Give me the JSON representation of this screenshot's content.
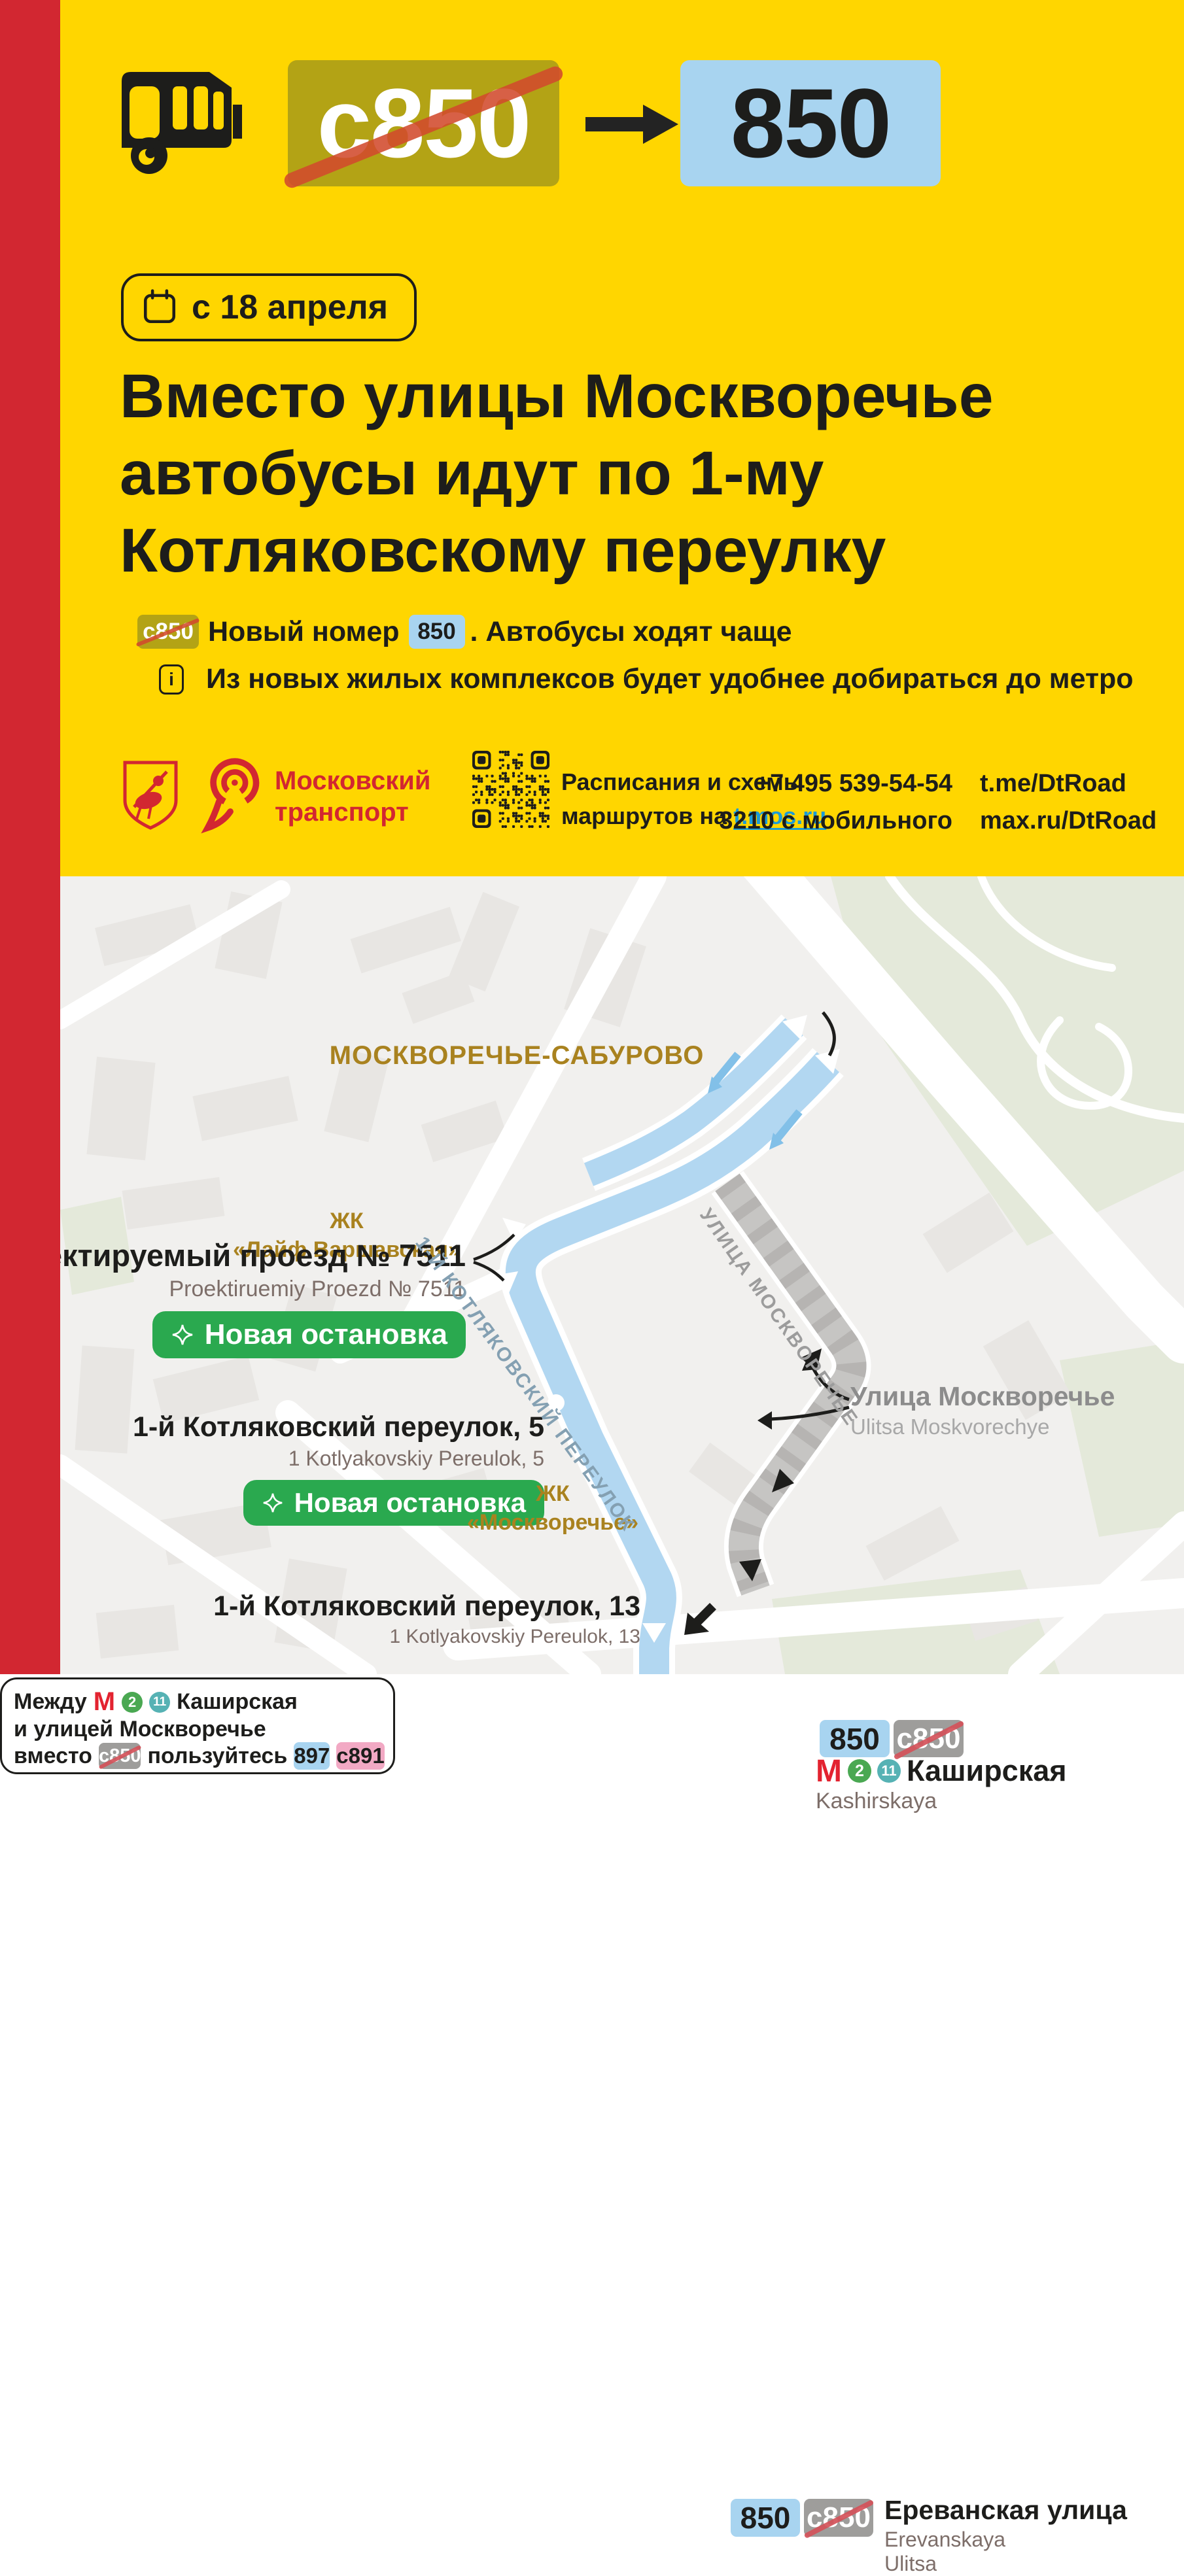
{
  "colors": {
    "yellow": "#ffd600",
    "red": "#d22731",
    "ink": "#1d1d1b",
    "olive": "#b3a315",
    "light_blue": "#a8d4f0",
    "strike": "#d14a2c",
    "strike_map": "#d4525a",
    "green": "#2aa94f",
    "gold": "#a9821f",
    "pink": "#f2a9c4",
    "link": "#1b9bd7",
    "metro_red": "#e32330",
    "line2": "#4aa852",
    "line11": "#56b2b4",
    "route_blue": "#b2d7f1",
    "route_arrow": "#82c0e8",
    "road_gray": "#c6c5c3",
    "map_bg": "#f1f0ee",
    "park": "#e4e9da",
    "building": "#e8e6e3",
    "translit": "#7d6e69",
    "street_gray": "#9c9c9c"
  },
  "header": {
    "old_route": "с850",
    "new_route": "850",
    "date_badge": "с 18 апреля",
    "headline": "Вместо улицы Москворечье\nавтобусы идут по 1-му\nКотляковскому переулку",
    "bullet_new_number": {
      "old_badge": "с850",
      "text": "Новый номер",
      "new_badge": "850",
      "tail": ". Автобусы ходят чаще"
    },
    "bullet_info": {
      "icon_glyph": "i",
      "text": "Из новых жилых комплексов будет удобнее добираться до метро"
    }
  },
  "footer": {
    "brand_line1": "Московский",
    "brand_line2": "транспорт",
    "schedule_line1": "Расписания и схемы",
    "schedule_line2_prefix": "маршрутов на ",
    "schedule_link": "t.mos.ru",
    "phone": "+7 495 539-54-54",
    "phone_mobile": "3210 с мобильного",
    "telegram": "t.me/DtRoad",
    "max": "max.ru/DtRoad"
  },
  "map": {
    "district": "МОСКВОРЕЧЬЕ-САБУРОВО",
    "kashirskaya": {
      "new_badge": "850",
      "old_badge": "с850",
      "metro": "М",
      "line2": "2",
      "line11": "11",
      "name": "Каширская",
      "translit": "Kashirskaya"
    },
    "zhk_life": {
      "line1": "ЖК",
      "line2": "«Лайф Варшавская»"
    },
    "stop_7511": {
      "name": "Проектируемый проезд № 7511",
      "translit": "Proektiruemiy Proezd № 7511",
      "badge": "Новая остановка"
    },
    "stop_k5": {
      "name": "1-й Котляковский переулок, 5",
      "translit": "1 Kotlyakovskiy Pereulok, 5",
      "badge": "Новая остановка"
    },
    "info_box": {
      "word_between": "Между",
      "metro": "М",
      "line2": "2",
      "line11": "11",
      "line1_name": "Каширская",
      "line2_text": "и улицей Москворечье",
      "word_instead": "вместо",
      "old_badge": "с850",
      "word_use": "пользуйтесь",
      "route_a": "897",
      "route_b": "с891"
    },
    "street_moskvorechye": {
      "name": "Улица Москворечье",
      "translit": "Ulitsa Moskvorechye"
    },
    "zhk_moskvorechye": {
      "line1": "ЖК",
      "line2": "«Москворечье»"
    },
    "street_diag_kotlyakovsky": "1-Й КОТЛЯКОВСКИЙ ПЕРЕУЛОК",
    "street_diag_moskvorechye": "УЛИЦА МОСКВОРЕЧЬЕ",
    "stop_k13": {
      "name": "1-й Котляковский переулок, 13",
      "translit": "1 Kotlyakovskiy Pereulok, 13"
    },
    "erevanskaya": {
      "new_badge": "850",
      "old_badge": "с850",
      "name": "Ереванская улица",
      "translit": "Erevanskaya Ulitsa"
    }
  }
}
